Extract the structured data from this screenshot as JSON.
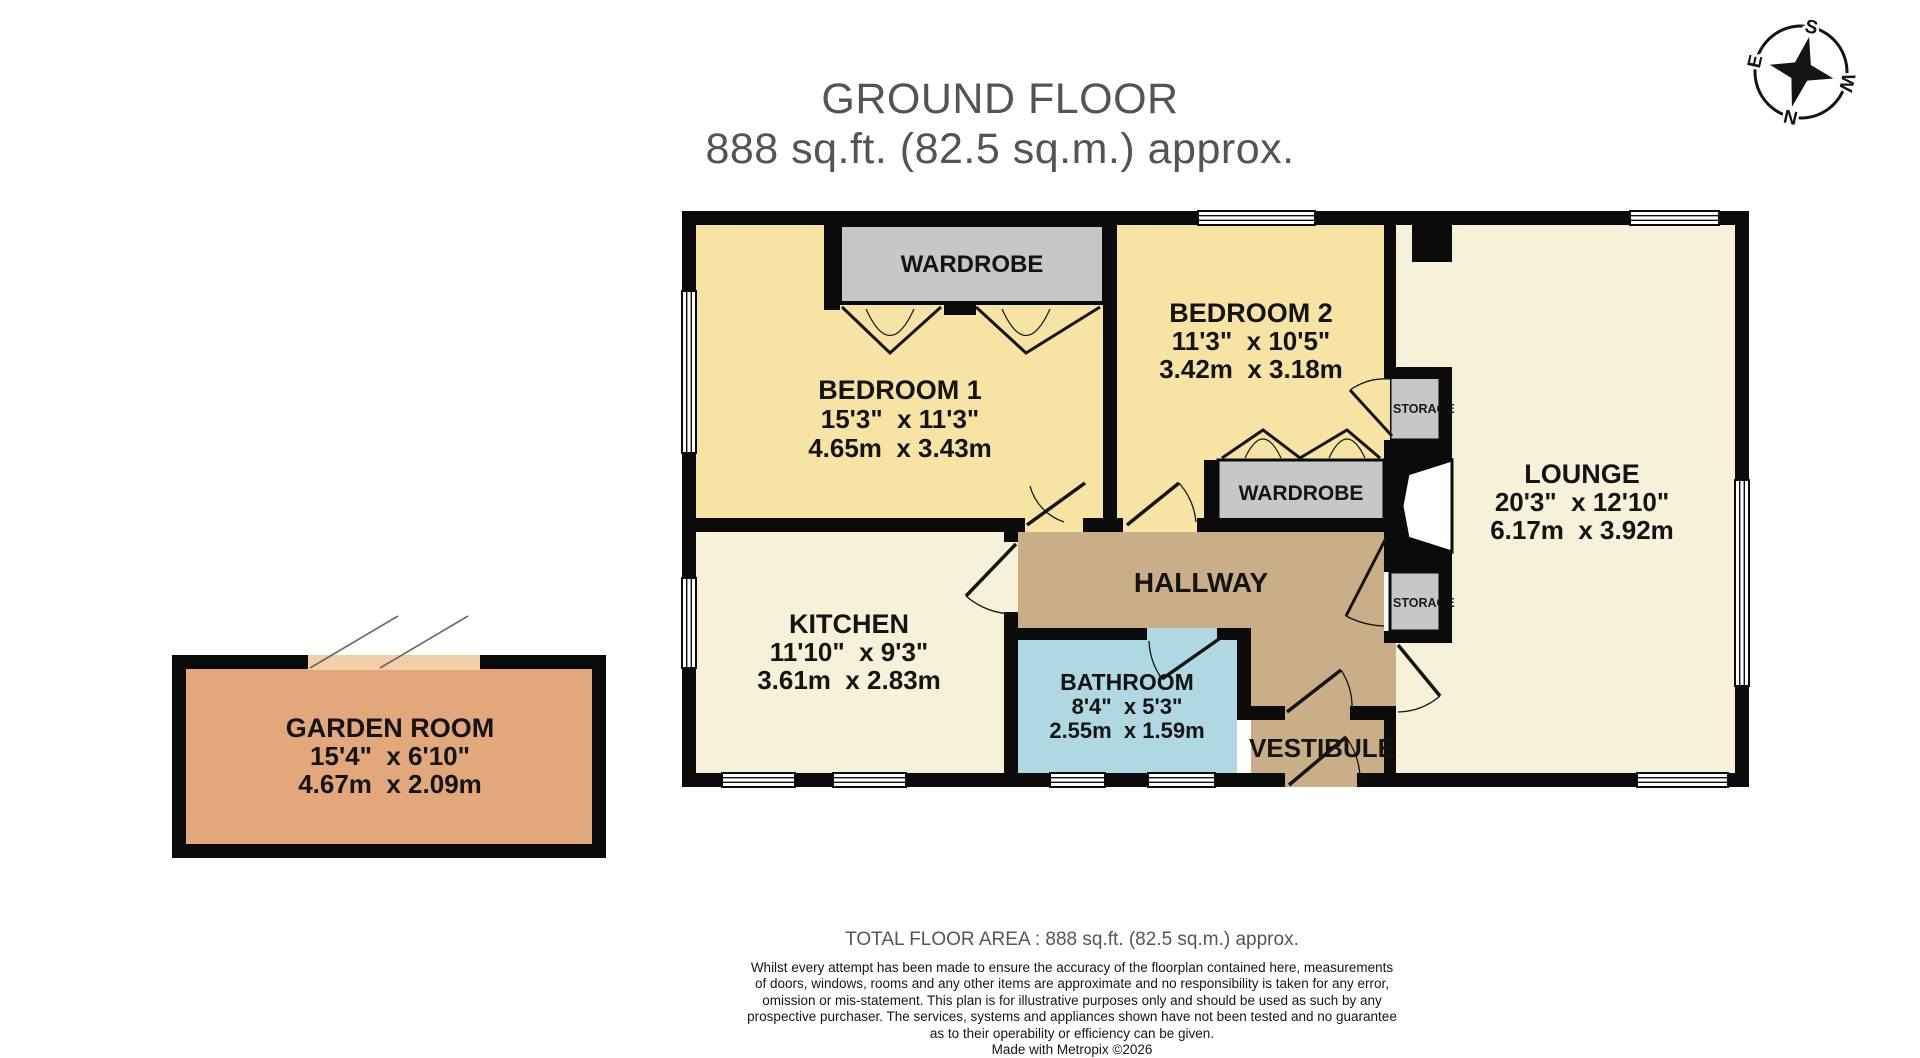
{
  "title": {
    "line1": "GROUND FLOOR",
    "line2": "888 sq.ft. (82.5 sq.m.) approx."
  },
  "compass": {
    "north": "N",
    "south": "S",
    "east": "E",
    "west": "W"
  },
  "rooms": {
    "bedroom1": {
      "name": "BEDROOM 1",
      "imperial": "15'3\"  x 11'3\"",
      "metric": "4.65m  x 3.43m"
    },
    "bedroom2": {
      "name": "BEDROOM 2",
      "imperial": "11'3\"  x 10'5\"",
      "metric": "3.42m  x 3.18m"
    },
    "lounge": {
      "name": "LOUNGE",
      "imperial": "20'3\"  x 12'10\"",
      "metric": "6.17m  x 3.92m"
    },
    "kitchen": {
      "name": "KITCHEN",
      "imperial": "11'10\"  x 9'3\"",
      "metric": "3.61m  x 2.83m"
    },
    "bathroom": {
      "name": "BATHROOM",
      "imperial": "8'4\"  x 5'3\"",
      "metric": "2.55m  x 1.59m"
    },
    "garden_room": {
      "name": "GARDEN ROOM",
      "imperial": "15'4\"  x 6'10\"",
      "metric": "4.67m  x 2.09m"
    },
    "hallway": {
      "name": "HALLWAY"
    },
    "vestibule": {
      "name": "VESTIBULE"
    },
    "wardrobe1": {
      "name": "WARDROBE"
    },
    "wardrobe2": {
      "name": "WARDROBE"
    },
    "storage1": {
      "name": "STORAGE"
    },
    "storage2": {
      "name": "STORAGE"
    }
  },
  "footer": {
    "total": "TOTAL FLOOR AREA : 888 sq.ft. (82.5 sq.m.) approx.",
    "disclaimer_lines": [
      "Whilst every attempt has been made to ensure the accuracy of the floorplan contained here, measurements",
      "of doors, windows, rooms and any other items are approximate and no responsibility is taken for any error,",
      "omission or mis-statement. This plan is for illustrative purposes only and should be used as such by any",
      "prospective purchaser. The services, systems and appliances shown have not been tested and no guarantee",
      "as to their operability or efficiency can be given."
    ],
    "credit": "Made with Metropix ©2026"
  },
  "colors": {
    "bedroom_fill": "#F7E3A4",
    "living_fill": "#F8F1D9",
    "hallway_fill": "#C9AE87",
    "bathroom_fill": "#AFD8E2",
    "garden_fill": "#E2A87C",
    "garden_threshold": "#F2CEA9",
    "fixture_gray": "#C7C7C7",
    "wall_black": "#0B0B0B",
    "title_gray": "#535456"
  }
}
